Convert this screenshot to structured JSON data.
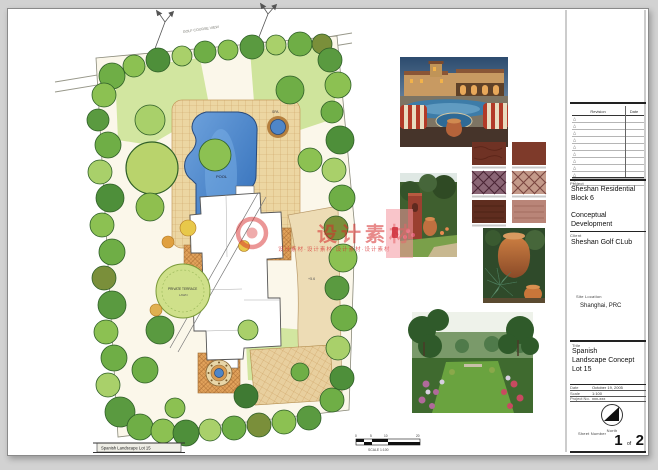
{
  "page": {
    "background": "#d2d2d2",
    "sheet_color": "#ffffff"
  },
  "watermark": {
    "main_text": "设计素材",
    "sub_text": "设计素材·设计素材·设计素材·设计素材",
    "color": "#d52a2a"
  },
  "plan": {
    "labels": {
      "golf_course_view": "GOLF COURSE VIEW",
      "cart_path": "CART PATH",
      "pool": "POOL",
      "spa": "SPA",
      "private_terrace": "PRIVATE TERRACE",
      "lawn": "LAWN",
      "spot_elevation": "+5.6",
      "sheet_label": "Spanish Landscape Lot 15",
      "scale_caption": "SCALE 1:100",
      "scale_ticks": [
        "0",
        "5",
        "10",
        "20"
      ]
    }
  },
  "title_block": {
    "revision_table": {
      "headers": [
        "Revision",
        "Date"
      ],
      "row_count": 10,
      "row_marker": "△"
    },
    "project_label": "Project",
    "project_line1": "Sheshan Residential",
    "project_line2": "Block 6",
    "phase_line1": "Conceptual",
    "phase_line2": "Development",
    "client_label": "Client",
    "client": "Sheshan Golf CLub",
    "site_location_label": "Site Location",
    "site_location": "Shanghai, PRC",
    "title_label": "Title",
    "title_line1": "Spanish",
    "title_line2": "Landscape Concept",
    "title_line3": "Lot 15",
    "date_label": "Date",
    "date_value": "October 19, 2005",
    "scale_label": "Scale",
    "scale_value": "1:100",
    "project_no_label": "Project No.",
    "project_no_value": "xxx-xxx",
    "north_label": "North",
    "sheet_number_label": "Sheet Number",
    "sheet_current": "1",
    "sheet_of": "of",
    "sheet_total": "2"
  }
}
